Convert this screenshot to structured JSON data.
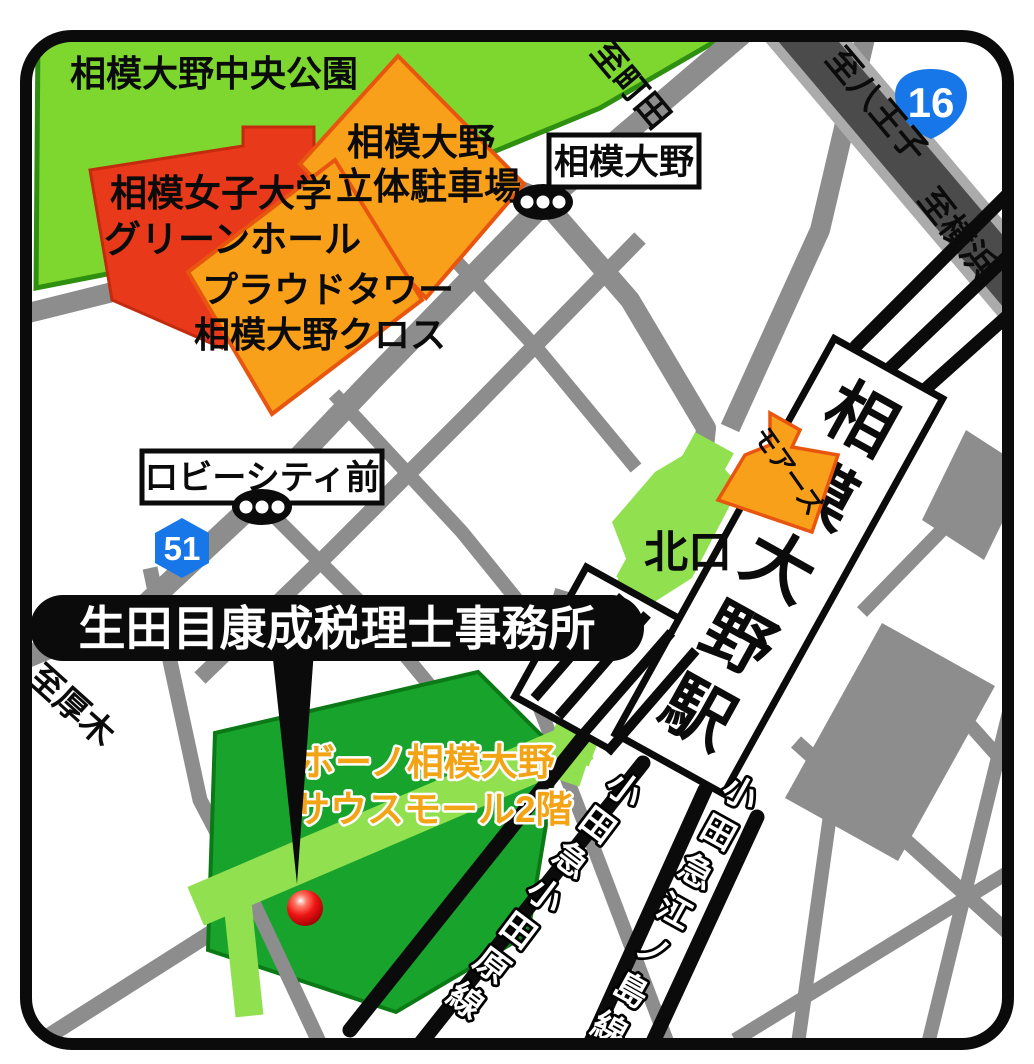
{
  "map": {
    "office": {
      "name": "生田目康成税理士事務所"
    },
    "park": {
      "label": "相模大野中央公園"
    },
    "university": {
      "line1": "相模女子大学",
      "line2": "グリーンホール"
    },
    "parking": {
      "line1": "相模大野",
      "line2": "立体駐車場"
    },
    "proud_tower": {
      "line1": "プラウドタワー",
      "line2": "相模大野クロス"
    },
    "mores": {
      "label": "モアーズ"
    },
    "station": {
      "name": "相模大野駅",
      "chars": [
        "相",
        "模",
        "大",
        "野",
        "駅"
      ],
      "north_exit": "北口"
    },
    "bono": {
      "line1": "ボーノ相模大野",
      "line2": "サウスモール2階"
    },
    "bus_stops": {
      "sagami_ono": "相模大野",
      "lobby_city_mae": "ロビーシティ前"
    },
    "routes": {
      "national_16": "16",
      "prefectural_51": "51"
    },
    "directions": {
      "machida": "至町田",
      "hachioji": "至八王子",
      "yokohama": "至横浜",
      "atsugi": "至厚木"
    },
    "railways": {
      "odawara": {
        "name": "小田急小田原線",
        "chars": [
          "小",
          "田",
          "急",
          "小",
          "田",
          "原",
          "線"
        ]
      },
      "enoshima": {
        "name": "小田急江ノ島線",
        "chars": [
          "小",
          "田",
          "急",
          "江",
          "ノ",
          "島",
          "線"
        ]
      }
    },
    "colors": {
      "road_gray": "#8d8d8d",
      "route16_dark": "#4b4b4b",
      "park_green": "#7ed72f",
      "building_green": "#18a42c",
      "deck_green": "#90e04f",
      "building_orange": "#f9a01b",
      "building_red": "#e8391a",
      "badge_blue": "#1877e8",
      "marker_red": "#e51515"
    }
  }
}
